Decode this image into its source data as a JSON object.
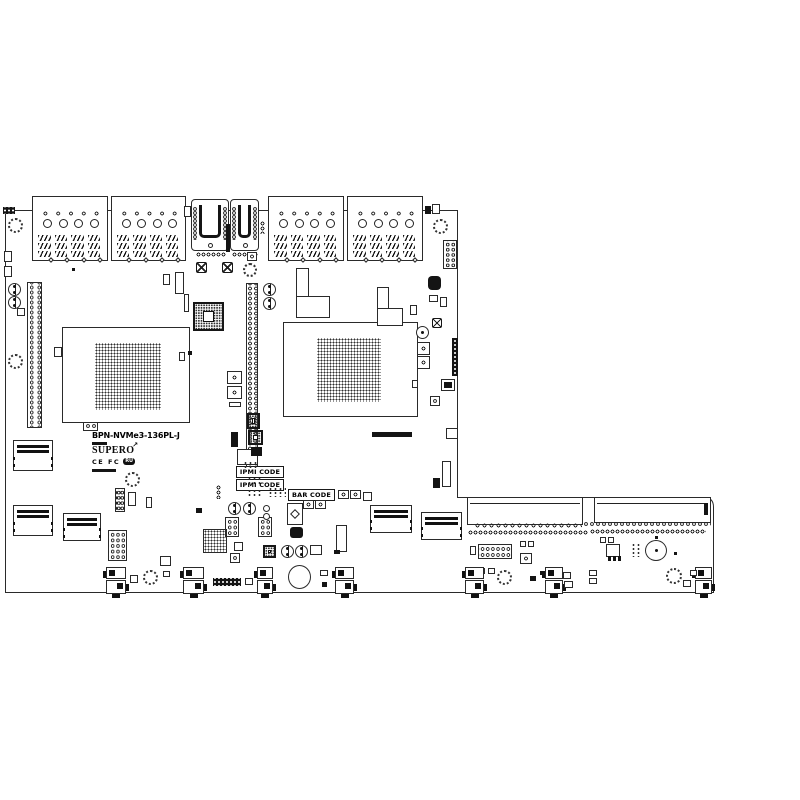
{
  "board": {
    "model": "BPN-NVMe3-136PL-J",
    "brand": "SUPER",
    "brand_o": "O",
    "rocket_glyph": "↗",
    "cert_text": "CE FC",
    "ul_mark": "RU",
    "colors": {
      "line": "#2a2a2a",
      "dark": "#141414",
      "bg": "#ffffff"
    }
  },
  "components": [
    {
      "t": "strip",
      "x": 3,
      "y": 207,
      "w": 12,
      "h": 7
    },
    {
      "t": "hdd",
      "x": 32,
      "y": 196,
      "w": 76,
      "h": 65
    },
    {
      "t": "hdd",
      "x": 111,
      "y": 196,
      "w": 75,
      "h": 65
    },
    {
      "t": "hdd",
      "x": 268,
      "y": 196,
      "w": 76,
      "h": 65
    },
    {
      "t": "hdd",
      "x": 347,
      "y": 196,
      "w": 76,
      "h": 65
    },
    {
      "t": "sas",
      "x": 191,
      "y": 199,
      "w": 38,
      "h": 52
    },
    {
      "t": "sas",
      "x": 230,
      "y": 199,
      "w": 29,
      "h": 52
    },
    {
      "t": "dk",
      "x": 226,
      "y": 224,
      "w": 4,
      "h": 28
    },
    {
      "t": "dots",
      "x": 196,
      "y": 252,
      "w": 30,
      "h": 5
    },
    {
      "t": "dots",
      "x": 232,
      "y": 252,
      "w": 26,
      "h": 5
    },
    {
      "t": "box",
      "x": 184,
      "y": 206,
      "w": 7,
      "h": 11
    },
    {
      "t": "dov",
      "x": 260,
      "y": 221,
      "w": 5,
      "h": 13
    },
    {
      "t": "led",
      "x": 247,
      "y": 252,
      "w": 10,
      "h": 9
    },
    {
      "t": "fan",
      "x": 8,
      "y": 218,
      "w": 15,
      "h": 15
    },
    {
      "t": "fan",
      "x": 433,
      "y": 219,
      "w": 15,
      "h": 15
    },
    {
      "t": "fan",
      "x": 243,
      "y": 263,
      "w": 14,
      "h": 14
    },
    {
      "t": "fan",
      "x": 8,
      "y": 354,
      "w": 15,
      "h": 15
    },
    {
      "t": "fan",
      "x": 125,
      "y": 472,
      "w": 15,
      "h": 15
    },
    {
      "t": "fan",
      "x": 143,
      "y": 570,
      "w": 15,
      "h": 15
    },
    {
      "t": "fan",
      "x": 497,
      "y": 570,
      "w": 15,
      "h": 15
    },
    {
      "t": "fan",
      "x": 666,
      "y": 568,
      "w": 16,
      "h": 16
    },
    {
      "t": "box",
      "x": 4,
      "y": 251,
      "w": 8,
      "h": 11
    },
    {
      "t": "box",
      "x": 4,
      "y": 266,
      "w": 8,
      "h": 11
    },
    {
      "t": "box",
      "x": 17,
      "y": 308,
      "w": 8,
      "h": 8
    },
    {
      "t": "box",
      "x": 54,
      "y": 347,
      "w": 8,
      "h": 10
    },
    {
      "t": "dk",
      "x": 72,
      "y": 268,
      "w": 3,
      "h": 3
    },
    {
      "t": "tgt",
      "x": 8,
      "y": 283,
      "w": 13,
      "h": 13
    },
    {
      "t": "tgt",
      "x": 8,
      "y": 296,
      "w": 13,
      "h": 13
    },
    {
      "t": "tgt",
      "x": 263,
      "y": 283,
      "w": 13,
      "h": 13
    },
    {
      "t": "tgt",
      "x": 263,
      "y": 297,
      "w": 13,
      "h": 13
    },
    {
      "t": "tgt",
      "x": 228,
      "y": 502,
      "w": 13,
      "h": 13
    },
    {
      "t": "tgt",
      "x": 243,
      "y": 502,
      "w": 13,
      "h": 13
    },
    {
      "t": "tgt",
      "x": 281,
      "y": 545,
      "w": 13,
      "h": 13
    },
    {
      "t": "tgt",
      "x": 295,
      "y": 545,
      "w": 13,
      "h": 13
    },
    {
      "t": "ph",
      "x": 27,
      "y": 282,
      "w": 15,
      "h": 146
    },
    {
      "t": "ph",
      "x": 246,
      "y": 283,
      "w": 12,
      "h": 190
    },
    {
      "t": "idc",
      "x": 443,
      "y": 240,
      "w": 14,
      "h": 29
    },
    {
      "t": "idc",
      "x": 83,
      "y": 420,
      "w": 15,
      "h": 11
    },
    {
      "t": "idc",
      "x": 108,
      "y": 530,
      "w": 19,
      "h": 31
    },
    {
      "t": "idc",
      "x": 478,
      "y": 544,
      "w": 34,
      "h": 15
    },
    {
      "t": "idc",
      "x": 115,
      "y": 488,
      "w": 10,
      "h": 24
    },
    {
      "t": "idc",
      "x": 225,
      "y": 517,
      "w": 14,
      "h": 20
    },
    {
      "t": "idc",
      "x": 258,
      "y": 517,
      "w": 14,
      "h": 20
    },
    {
      "t": "x",
      "x": 196,
      "y": 262,
      "w": 11,
      "h": 11
    },
    {
      "t": "x",
      "x": 222,
      "y": 262,
      "w": 11,
      "h": 11
    },
    {
      "t": "x",
      "x": 432,
      "y": 318,
      "w": 10,
      "h": 10
    },
    {
      "t": "qfp",
      "x": 193,
      "y": 302,
      "w": 31,
      "h": 29
    },
    {
      "t": "qfp",
      "x": 247,
      "y": 413,
      "w": 13,
      "h": 16
    },
    {
      "t": "qfp",
      "x": 248,
      "y": 430,
      "w": 15,
      "h": 15
    },
    {
      "t": "qfp",
      "x": 263,
      "y": 545,
      "w": 13,
      "h": 13
    },
    {
      "t": "dotsq",
      "x": 203,
      "y": 529,
      "w": 24,
      "h": 24
    },
    {
      "t": "box",
      "x": 62,
      "y": 327,
      "w": 128,
      "h": 96
    },
    {
      "t": "box",
      "x": 283,
      "y": 322,
      "w": 135,
      "h": 95
    },
    {
      "t": "grid",
      "x": 95,
      "y": 343,
      "w": 66,
      "h": 67
    },
    {
      "t": "grid",
      "x": 317,
      "y": 338,
      "w": 64,
      "h": 64
    },
    {
      "t": "box",
      "x": 163,
      "y": 274,
      "w": 7,
      "h": 11
    },
    {
      "t": "box",
      "x": 175,
      "y": 272,
      "w": 9,
      "h": 22
    },
    {
      "t": "box",
      "x": 184,
      "y": 294,
      "w": 5,
      "h": 18
    },
    {
      "t": "box",
      "x": 179,
      "y": 352,
      "w": 6,
      "h": 9
    },
    {
      "t": "dk",
      "x": 188,
      "y": 351,
      "w": 4,
      "h": 4
    },
    {
      "t": "box",
      "x": 296,
      "y": 268,
      "w": 13,
      "h": 30
    },
    {
      "t": "box",
      "x": 296,
      "y": 296,
      "w": 34,
      "h": 22
    },
    {
      "t": "box",
      "x": 377,
      "y": 287,
      "w": 12,
      "h": 26
    },
    {
      "t": "box",
      "x": 377,
      "y": 308,
      "w": 26,
      "h": 18
    },
    {
      "t": "dk",
      "x": 425,
      "y": 206,
      "w": 6,
      "h": 8
    },
    {
      "t": "box",
      "x": 432,
      "y": 204,
      "w": 8,
      "h": 10
    },
    {
      "t": "dk",
      "x": 428,
      "y": 276,
      "w": 13,
      "h": 14,
      "r": 4
    },
    {
      "t": "box",
      "x": 429,
      "y": 295,
      "w": 9,
      "h": 7
    },
    {
      "t": "box",
      "x": 440,
      "y": 297,
      "w": 7,
      "h": 10
    },
    {
      "t": "box",
      "x": 410,
      "y": 305,
      "w": 7,
      "h": 10
    },
    {
      "t": "cap",
      "x": 416,
      "y": 326,
      "w": 13,
      "h": 13
    },
    {
      "t": "led",
      "x": 417,
      "y": 342,
      "w": 13,
      "h": 13
    },
    {
      "t": "led",
      "x": 417,
      "y": 356,
      "w": 13,
      "h": 13
    },
    {
      "t": "strip",
      "x": 452,
      "y": 338,
      "w": 6,
      "h": 38
    },
    {
      "t": "box",
      "x": 441,
      "y": 379,
      "w": 14,
      "h": 12
    },
    {
      "t": "dk",
      "x": 444,
      "y": 382,
      "w": 8,
      "h": 6
    },
    {
      "t": "box",
      "x": 412,
      "y": 380,
      "w": 6,
      "h": 8
    },
    {
      "t": "led",
      "x": 430,
      "y": 396,
      "w": 10,
      "h": 10
    },
    {
      "t": "box",
      "x": 446,
      "y": 428,
      "w": 12,
      "h": 11
    },
    {
      "t": "box",
      "x": 442,
      "y": 461,
      "w": 9,
      "h": 26
    },
    {
      "t": "dk",
      "x": 433,
      "y": 478,
      "w": 7,
      "h": 10
    },
    {
      "t": "led",
      "x": 227,
      "y": 371,
      "w": 15,
      "h": 13
    },
    {
      "t": "led",
      "x": 227,
      "y": 386,
      "w": 15,
      "h": 13
    },
    {
      "t": "box",
      "x": 229,
      "y": 402,
      "w": 12,
      "h": 5
    },
    {
      "t": "dov",
      "x": 216,
      "y": 485,
      "w": 5,
      "h": 14
    },
    {
      "t": "dk",
      "x": 196,
      "y": 508,
      "w": 6,
      "h": 5
    },
    {
      "t": "box",
      "x": 234,
      "y": 542,
      "w": 9,
      "h": 9
    },
    {
      "t": "led",
      "x": 230,
      "y": 553,
      "w": 10,
      "h": 10
    },
    {
      "t": "box",
      "x": 160,
      "y": 556,
      "w": 11,
      "h": 10
    },
    {
      "t": "dk",
      "x": 372,
      "y": 432,
      "w": 40,
      "h": 5
    },
    {
      "t": "dk",
      "x": 231,
      "y": 432,
      "w": 7,
      "h": 15
    },
    {
      "t": "box",
      "x": 237,
      "y": 449,
      "w": 21,
      "h": 16
    },
    {
      "t": "dk",
      "x": 251,
      "y": 447,
      "w": 11,
      "h": 9
    },
    {
      "t": "lbl",
      "x": 236,
      "y": 466,
      "w": 48,
      "h": 12,
      "label": "IPMI CODE"
    },
    {
      "t": "lbl",
      "x": 236,
      "y": 479,
      "w": 48,
      "h": 12,
      "label": "IPMI CODE"
    },
    {
      "t": "lbl",
      "x": 288,
      "y": 489,
      "w": 47,
      "h": 12,
      "label": "BAR CODE"
    },
    {
      "t": "dotg",
      "x": 247,
      "y": 477,
      "w": 16,
      "h": 8
    },
    {
      "t": "dotg",
      "x": 247,
      "y": 489,
      "w": 16,
      "h": 8
    },
    {
      "t": "dotg",
      "x": 268,
      "y": 487,
      "w": 18,
      "h": 10
    },
    {
      "t": "dotg",
      "x": 243,
      "y": 461,
      "w": 15,
      "h": 7
    },
    {
      "t": "dotg",
      "x": 631,
      "y": 543,
      "w": 10,
      "h": 14
    },
    {
      "t": "led",
      "x": 338,
      "y": 490,
      "w": 11,
      "h": 9
    },
    {
      "t": "led",
      "x": 350,
      "y": 490,
      "w": 11,
      "h": 9
    },
    {
      "t": "box",
      "x": 363,
      "y": 492,
      "w": 9,
      "h": 9
    },
    {
      "t": "dia",
      "x": 287,
      "y": 503,
      "w": 16,
      "h": 22
    },
    {
      "t": "led",
      "x": 303,
      "y": 500,
      "w": 11,
      "h": 9
    },
    {
      "t": "led",
      "x": 315,
      "y": 500,
      "w": 11,
      "h": 9
    },
    {
      "t": "dk",
      "x": 290,
      "y": 527,
      "w": 13,
      "h": 11,
      "r": 3
    },
    {
      "t": "box",
      "x": 336,
      "y": 525,
      "w": 11,
      "h": 27
    },
    {
      "t": "circ",
      "x": 263,
      "y": 505,
      "w": 7,
      "h": 7
    },
    {
      "t": "circ",
      "x": 263,
      "y": 513,
      "w": 7,
      "h": 7
    },
    {
      "t": "box",
      "x": 310,
      "y": 545,
      "w": 12,
      "h": 10
    },
    {
      "t": "dk",
      "x": 334,
      "y": 550,
      "w": 6,
      "h": 4
    },
    {
      "t": "pwr",
      "x": 13,
      "y": 440,
      "w": 40,
      "h": 31
    },
    {
      "t": "pwr",
      "x": 13,
      "y": 505,
      "w": 40,
      "h": 31
    },
    {
      "t": "pwr",
      "x": 63,
      "y": 513,
      "w": 38,
      "h": 28
    },
    {
      "t": "pwr",
      "x": 370,
      "y": 505,
      "w": 42,
      "h": 28
    },
    {
      "t": "pwr",
      "x": 421,
      "y": 512,
      "w": 41,
      "h": 28
    },
    {
      "t": "edge",
      "x": 467,
      "y": 497,
      "w": 116,
      "h": 28
    },
    {
      "t": "edge",
      "x": 594,
      "y": 497,
      "w": 117,
      "h": 26
    },
    {
      "t": "dk",
      "x": 704,
      "y": 503,
      "w": 4,
      "h": 12
    },
    {
      "t": "dots",
      "x": 474,
      "y": 522,
      "w": 108,
      "h": 7
    },
    {
      "t": "dots",
      "x": 468,
      "y": 530,
      "w": 120,
      "h": 5
    },
    {
      "t": "dots",
      "x": 583,
      "y": 521,
      "w": 128,
      "h": 6
    },
    {
      "t": "dots",
      "x": 590,
      "y": 529,
      "w": 116,
      "h": 5
    },
    {
      "t": "box",
      "x": 470,
      "y": 546,
      "w": 6,
      "h": 9
    },
    {
      "t": "box",
      "x": 520,
      "y": 541,
      "w": 6,
      "h": 6
    },
    {
      "t": "box",
      "x": 528,
      "y": 541,
      "w": 6,
      "h": 6
    },
    {
      "t": "led",
      "x": 520,
      "y": 553,
      "w": 12,
      "h": 11
    },
    {
      "t": "box",
      "x": 478,
      "y": 568,
      "w": 7,
      "h": 6
    },
    {
      "t": "box",
      "x": 488,
      "y": 568,
      "w": 7,
      "h": 6
    },
    {
      "t": "fanc",
      "x": 106,
      "y": 567,
      "w": 20,
      "h": 31
    },
    {
      "t": "fanc",
      "x": 183,
      "y": 567,
      "w": 21,
      "h": 31
    },
    {
      "t": "fanc",
      "x": 257,
      "y": 567,
      "w": 16,
      "h": 31
    },
    {
      "t": "fanc",
      "x": 335,
      "y": 567,
      "w": 19,
      "h": 31
    },
    {
      "t": "fanc",
      "x": 465,
      "y": 567,
      "w": 19,
      "h": 31
    },
    {
      "t": "fanc",
      "x": 545,
      "y": 567,
      "w": 18,
      "h": 31
    },
    {
      "t": "fanc",
      "x": 695,
      "y": 567,
      "w": 17,
      "h": 31
    },
    {
      "t": "strip",
      "x": 213,
      "y": 578,
      "w": 28,
      "h": 8
    },
    {
      "t": "box",
      "x": 130,
      "y": 575,
      "w": 8,
      "h": 8
    },
    {
      "t": "box",
      "x": 146,
      "y": 497,
      "w": 6,
      "h": 11
    },
    {
      "t": "box",
      "x": 128,
      "y": 492,
      "w": 8,
      "h": 14
    },
    {
      "t": "box",
      "x": 163,
      "y": 571,
      "w": 7,
      "h": 6
    },
    {
      "t": "box",
      "x": 245,
      "y": 578,
      "w": 8,
      "h": 7
    },
    {
      "t": "circ",
      "x": 288,
      "y": 565,
      "w": 23,
      "h": 24
    },
    {
      "t": "box",
      "x": 320,
      "y": 570,
      "w": 8,
      "h": 6
    },
    {
      "t": "dk",
      "x": 322,
      "y": 582,
      "w": 5,
      "h": 5
    },
    {
      "t": "dk",
      "x": 530,
      "y": 576,
      "w": 6,
      "h": 5
    },
    {
      "t": "dk",
      "x": 540,
      "y": 571,
      "w": 5,
      "h": 4
    },
    {
      "t": "box",
      "x": 563,
      "y": 572,
      "w": 8,
      "h": 7
    },
    {
      "t": "box",
      "x": 564,
      "y": 581,
      "w": 9,
      "h": 7
    },
    {
      "t": "box",
      "x": 589,
      "y": 570,
      "w": 8,
      "h": 6
    },
    {
      "t": "box",
      "x": 589,
      "y": 578,
      "w": 8,
      "h": 6
    },
    {
      "t": "box",
      "x": 600,
      "y": 537,
      "w": 6,
      "h": 6
    },
    {
      "t": "box",
      "x": 608,
      "y": 537,
      "w": 6,
      "h": 6
    },
    {
      "t": "box",
      "x": 606,
      "y": 544,
      "w": 14,
      "h": 13
    },
    {
      "t": "dk",
      "x": 608,
      "y": 556,
      "w": 3,
      "h": 5
    },
    {
      "t": "dk",
      "x": 613,
      "y": 556,
      "w": 3,
      "h": 5
    },
    {
      "t": "dk",
      "x": 618,
      "y": 556,
      "w": 3,
      "h": 5
    },
    {
      "t": "cap",
      "x": 645,
      "y": 540,
      "w": 22,
      "h": 21
    },
    {
      "t": "dk",
      "x": 655,
      "y": 536,
      "w": 3,
      "h": 3
    },
    {
      "t": "dk",
      "x": 674,
      "y": 552,
      "w": 3,
      "h": 3
    },
    {
      "t": "box",
      "x": 690,
      "y": 570,
      "w": 7,
      "h": 6
    },
    {
      "t": "box",
      "x": 683,
      "y": 580,
      "w": 8,
      "h": 7
    }
  ]
}
